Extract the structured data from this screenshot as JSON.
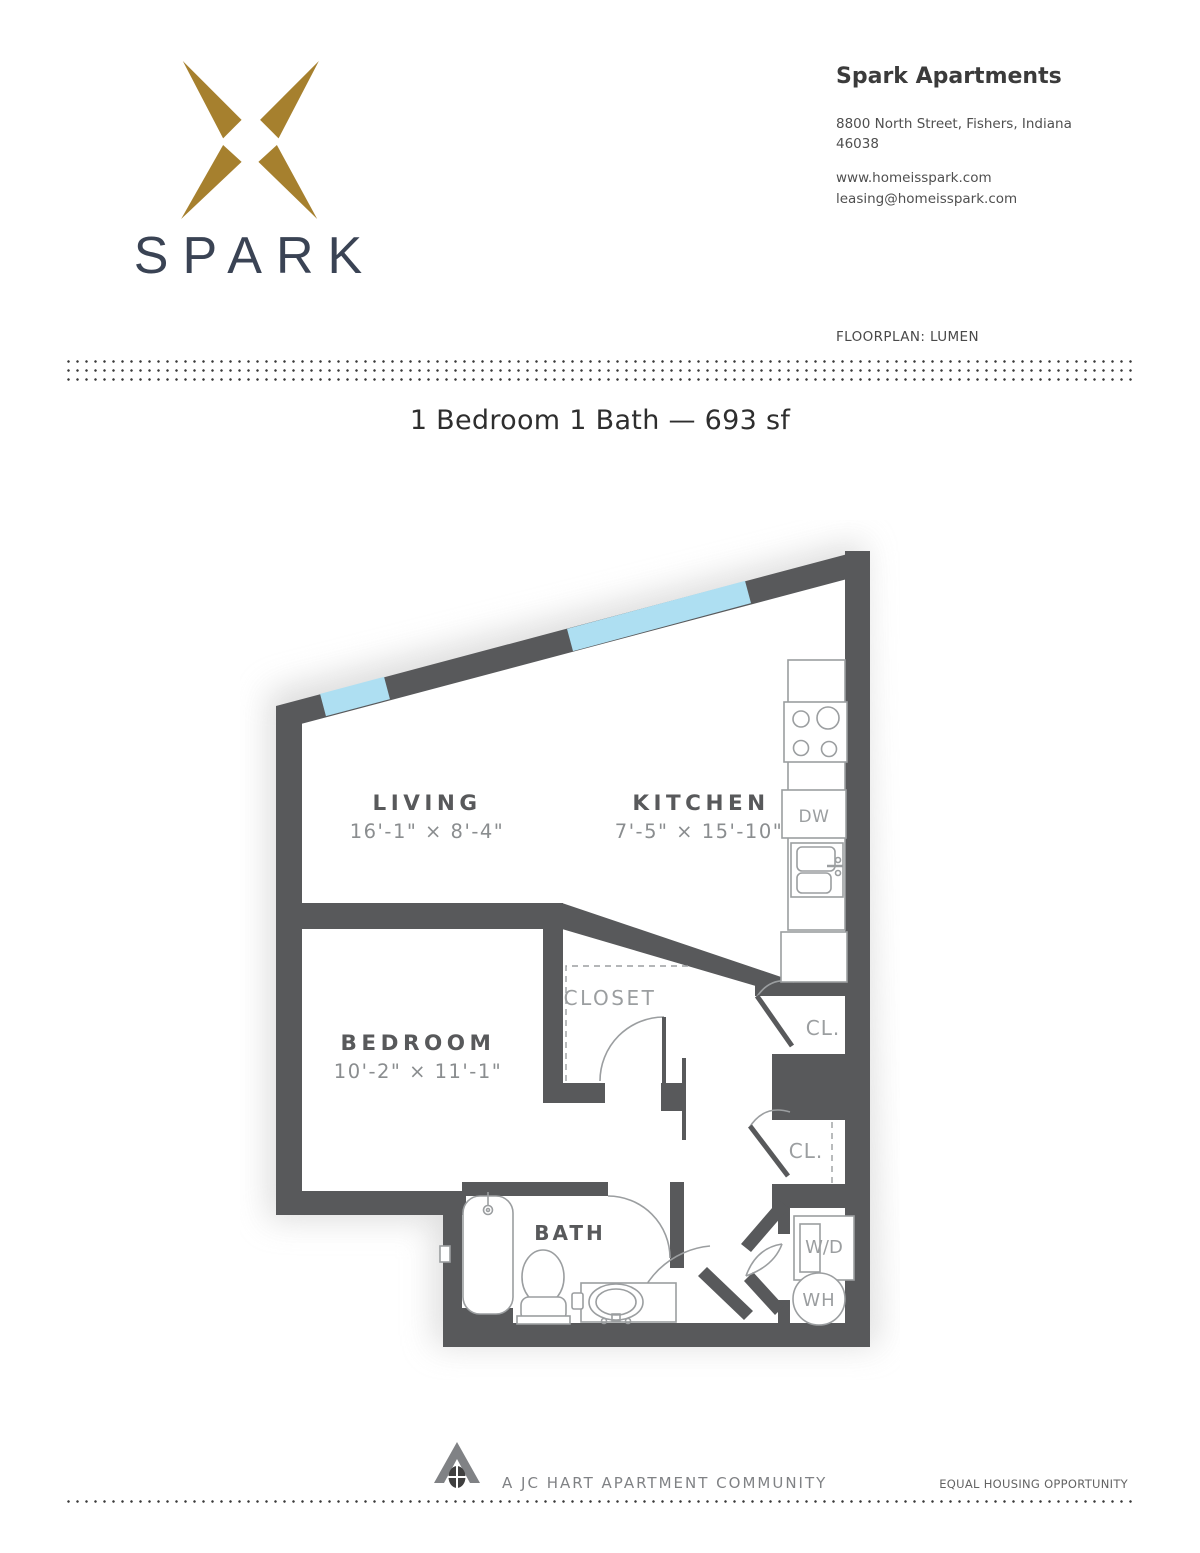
{
  "brand": {
    "wordmark": "SPARK",
    "colors": {
      "gold": "#A6802E",
      "navy": "#3A4354"
    }
  },
  "header": {
    "property_name": "Spark Apartments",
    "address_line1": "8800 North Street, Fishers, Indiana",
    "address_line2": "46038",
    "website": "www.homeisspark.com",
    "email": "leasing@homeisspark.com",
    "floorplan_label": "FLOORPLAN: LUMEN"
  },
  "title": "1 Bedroom 1 Bath — 693 sf",
  "floorplan": {
    "rooms": {
      "living": {
        "name": "LIVING",
        "dims": "16'-1\" × 8'-4\""
      },
      "kitchen": {
        "name": "KITCHEN",
        "dims": "7'-5\" × 15'-10\""
      },
      "bedroom": {
        "name": "BEDROOM",
        "dims": "10'-2\" × 11'-1\""
      },
      "closet": {
        "name": "CLOSET"
      },
      "bath": {
        "name": "BATH"
      },
      "closet1": {
        "name": "CL."
      },
      "closet2": {
        "name": "CL."
      }
    },
    "appliances": {
      "dishwasher": "DW",
      "washer_dryer": "W/D",
      "water_heater": "WH"
    },
    "colors": {
      "wall": "#58595B",
      "window": "#AEDFF2",
      "fixture_outline": "#9B9EA0",
      "room_label": "#58595B",
      "dim_label": "#8A8D8F"
    }
  },
  "footer": {
    "community": "A JC HART APARTMENT COMMUNITY",
    "equal_housing": "EQUAL HOUSING OPPORTUNITY"
  }
}
